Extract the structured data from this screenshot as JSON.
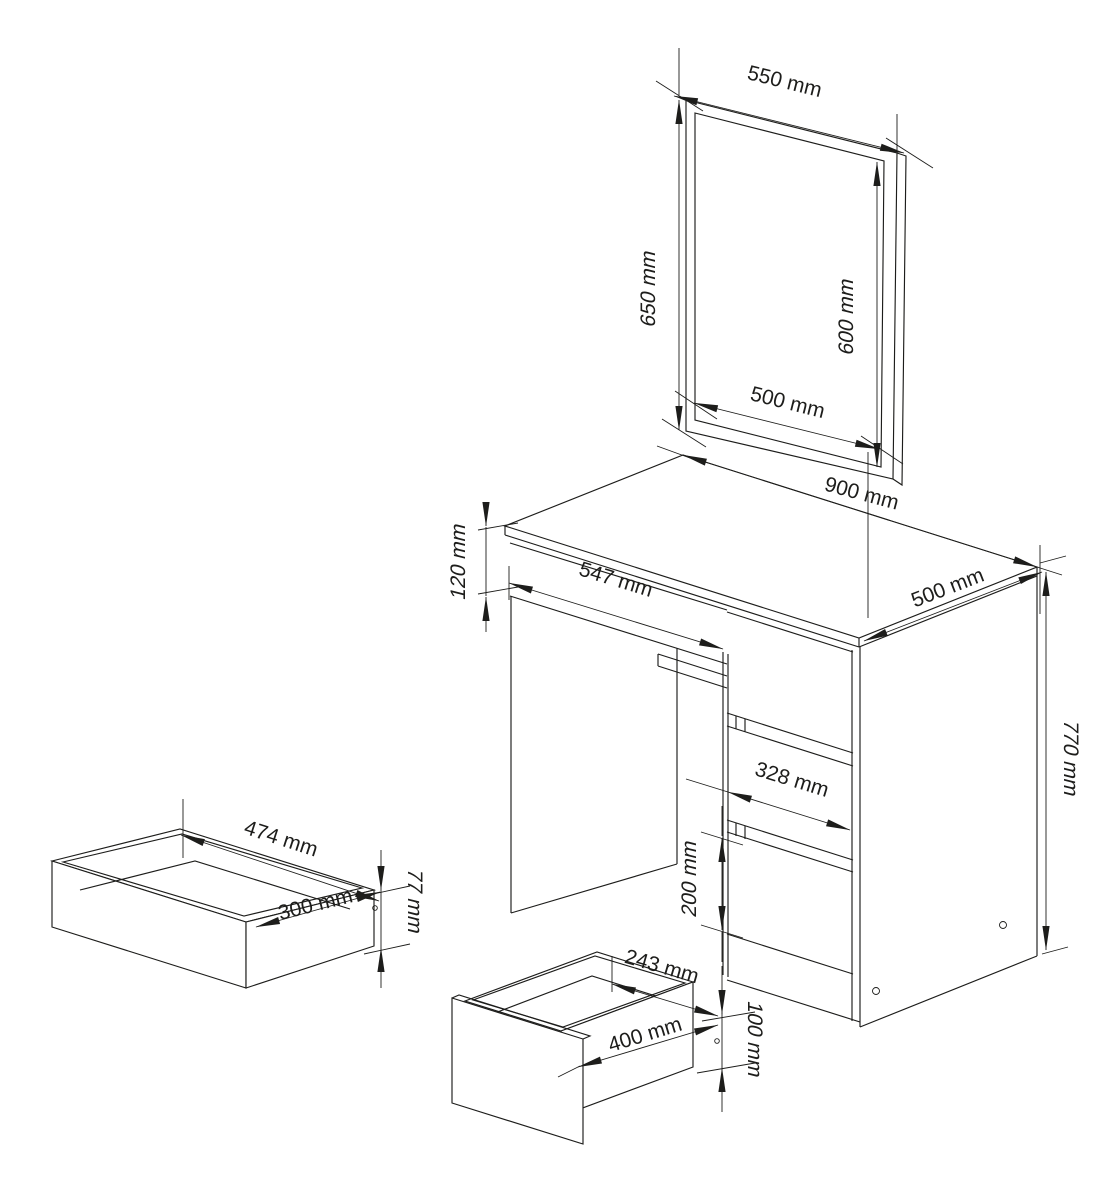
{
  "drawing": {
    "kind": "furniture-dimension-diagram",
    "product": "dressing table with mirror and pull-out drawers",
    "units": "mm",
    "line_color": "#1d1d1b",
    "background_color": "#ffffff",
    "parts": {
      "mirror": {
        "name": "mirror panel"
      },
      "desk": {
        "name": "dressing table body"
      },
      "wide_drawer": {
        "name": "wide drawer box"
      },
      "small_drawer": {
        "name": "small drawer box"
      }
    },
    "dimensions": [
      {
        "id": "mirror-outer-width",
        "part": "mirror",
        "value": 550,
        "unit": "mm",
        "label": "550 mm"
      },
      {
        "id": "mirror-outer-height",
        "part": "mirror",
        "value": 650,
        "unit": "mm",
        "label": "650 mm"
      },
      {
        "id": "mirror-inner-height",
        "part": "mirror",
        "value": 600,
        "unit": "mm",
        "label": "600 mm"
      },
      {
        "id": "mirror-inner-width",
        "part": "mirror",
        "value": 500,
        "unit": "mm",
        "label": "500 mm"
      },
      {
        "id": "desk-width",
        "part": "desk",
        "value": 900,
        "unit": "mm",
        "label": "900 mm"
      },
      {
        "id": "desk-depth",
        "part": "desk",
        "value": 500,
        "unit": "mm",
        "label": "500 mm"
      },
      {
        "id": "desk-apron-height",
        "part": "desk",
        "value": 120,
        "unit": "mm",
        "label": "120 mm"
      },
      {
        "id": "desk-knee-opening-width",
        "part": "desk",
        "value": 547,
        "unit": "mm",
        "label": "547 mm"
      },
      {
        "id": "desk-height",
        "part": "desk",
        "value": 770,
        "unit": "mm",
        "label": "770 mm"
      },
      {
        "id": "drawer-front-width",
        "part": "desk",
        "value": 328,
        "unit": "mm",
        "label": "328 mm"
      },
      {
        "id": "bottom-drawer-front-height",
        "part": "desk",
        "value": 200,
        "unit": "mm",
        "label": "200 mm"
      },
      {
        "id": "base-height",
        "part": "desk",
        "value": 100,
        "unit": "mm",
        "label": "100 mm"
      },
      {
        "id": "wide-drawer-inner-width",
        "part": "wide_drawer",
        "value": 474,
        "unit": "mm",
        "label": "474 mm"
      },
      {
        "id": "wide-drawer-depth",
        "part": "wide_drawer",
        "value": 300,
        "unit": "mm",
        "label": "300 mm"
      },
      {
        "id": "wide-drawer-height",
        "part": "wide_drawer",
        "value": 77,
        "unit": "mm",
        "label": "77 mm"
      },
      {
        "id": "small-drawer-inner-width",
        "part": "small_drawer",
        "value": 243,
        "unit": "mm",
        "label": "243 mm"
      },
      {
        "id": "small-drawer-depth",
        "part": "small_drawer",
        "value": 400,
        "unit": "mm",
        "label": "400 mm"
      }
    ]
  }
}
